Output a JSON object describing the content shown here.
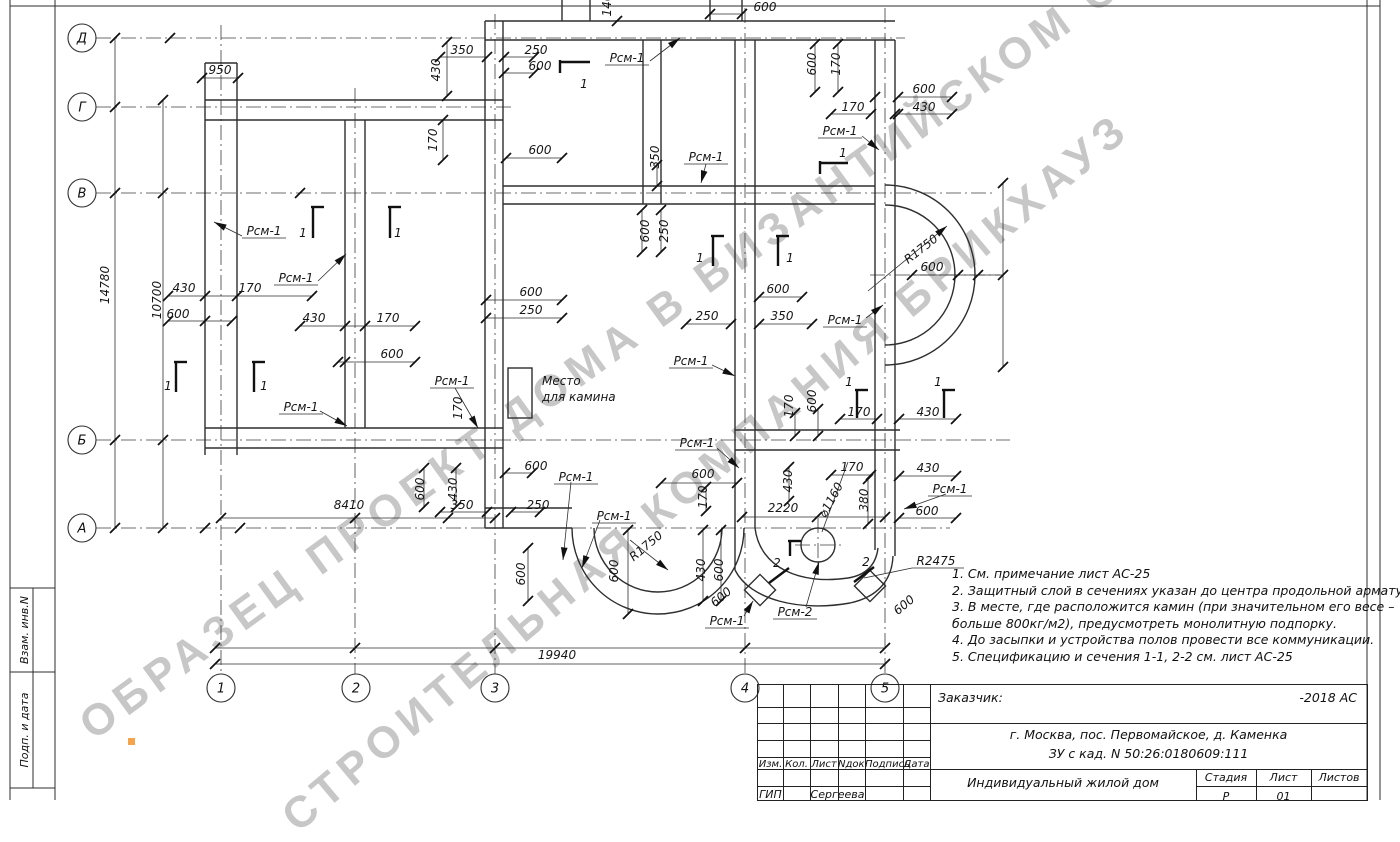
{
  "watermark": {
    "line1": "ОБРАЗЕЦ ПРОЕКТ ДОМА В ВИЗАНТИЙСКОМ СТИЛЕ",
    "line2": "СТРОИТЕЛЬНАЯ КОМПАНИЯ БРИКХАУЗ",
    "color": "#c7c7c7"
  },
  "sidebar": {
    "cells": [
      "Взам. инв.N",
      "Подп. и дата"
    ]
  },
  "axes": {
    "rows": [
      {
        "label": "Д",
        "y": 38
      },
      {
        "label": "Г",
        "y": 107
      },
      {
        "label": "В",
        "y": 193
      },
      {
        "label": "Б",
        "y": 440
      },
      {
        "label": "А",
        "y": 528
      }
    ],
    "cols": [
      {
        "label": "1",
        "x": 221
      },
      {
        "label": "2",
        "x": 356
      },
      {
        "label": "3",
        "x": 495
      },
      {
        "label": "4",
        "x": 745
      },
      {
        "label": "5",
        "x": 885
      }
    ]
  },
  "notes": {
    "lines": [
      "1. См. примечание лист АС-25",
      "2. Защитный слой в сечениях указан до центра продольной арматуры.",
      "3. В месте, где расположится камин (при значительном его весе –",
      "больше 800кг/м2), предусмотреть монолитную подпорку.",
      "4. До засыпки и устройства полов провести все коммуникации.",
      "5. Спецификацию и сечения 1-1, 2-2 см. лист АС-25"
    ]
  },
  "labels": [
    {
      "t": "950",
      "x": 220,
      "y": 70
    },
    {
      "t": "14780",
      "x": 105,
      "y": 285,
      "r": -90
    },
    {
      "t": "10700",
      "x": 157,
      "y": 300,
      "r": -90
    },
    {
      "t": "430",
      "x": 184,
      "y": 288
    },
    {
      "t": "170",
      "x": 250,
      "y": 288
    },
    {
      "t": "600",
      "x": 178,
      "y": 314
    },
    {
      "t": "Рсм-1",
      "x": 264,
      "y": 231,
      "u": 1
    },
    {
      "t": "Рсм-1",
      "x": 296,
      "y": 278,
      "u": 1
    },
    {
      "t": "Рсм-1",
      "x": 301,
      "y": 407,
      "u": 1
    },
    {
      "t": "430",
      "x": 314,
      "y": 318
    },
    {
      "t": "170",
      "x": 388,
      "y": 318
    },
    {
      "t": "600",
      "x": 392,
      "y": 354
    },
    {
      "t": "1",
      "x": 303,
      "y": 233
    },
    {
      "t": "1",
      "x": 398,
      "y": 233
    },
    {
      "t": "1",
      "x": 168,
      "y": 386
    },
    {
      "t": "1",
      "x": 264,
      "y": 386
    },
    {
      "t": "350",
      "x": 462,
      "y": 50
    },
    {
      "t": "250",
      "x": 536,
      "y": 50
    },
    {
      "t": "600",
      "x": 540,
      "y": 66
    },
    {
      "t": "430",
      "x": 436,
      "y": 70,
      "r": -90
    },
    {
      "t": "170",
      "x": 433,
      "y": 140,
      "r": -90
    },
    {
      "t": "600",
      "x": 540,
      "y": 150
    },
    {
      "t": "350",
      "x": 655,
      "y": 157,
      "r": -90
    },
    {
      "t": "Рсм-1",
      "x": 706,
      "y": 157,
      "u": 1
    },
    {
      "t": "Рсм-1",
      "x": 627,
      "y": 58,
      "u": 1
    },
    {
      "t": "1",
      "x": 584,
      "y": 84
    },
    {
      "t": "140",
      "x": 607,
      "y": 5,
      "r": -90
    },
    {
      "t": "600",
      "x": 765,
      "y": 7
    },
    {
      "t": "600",
      "x": 812,
      "y": 64,
      "r": -90
    },
    {
      "t": "170",
      "x": 836,
      "y": 64,
      "r": -90
    },
    {
      "t": "600",
      "x": 924,
      "y": 89
    },
    {
      "t": "430",
      "x": 924,
      "y": 107
    },
    {
      "t": "170",
      "x": 853,
      "y": 107
    },
    {
      "t": "Рсм-1",
      "x": 840,
      "y": 131,
      "u": 1
    },
    {
      "t": "1",
      "x": 843,
      "y": 153
    },
    {
      "t": "600",
      "x": 645,
      "y": 231,
      "r": -90
    },
    {
      "t": "250",
      "x": 664,
      "y": 231,
      "r": -90
    },
    {
      "t": "1",
      "x": 700,
      "y": 258
    },
    {
      "t": "1",
      "x": 790,
      "y": 258
    },
    {
      "t": "600",
      "x": 531,
      "y": 292
    },
    {
      "t": "250",
      "x": 531,
      "y": 310
    },
    {
      "t": "250",
      "x": 707,
      "y": 316
    },
    {
      "t": "350",
      "x": 782,
      "y": 316
    },
    {
      "t": "600",
      "x": 778,
      "y": 289
    },
    {
      "t": "Рсм-1",
      "x": 845,
      "y": 320,
      "u": 1
    },
    {
      "t": "R1750",
      "x": 921,
      "y": 249,
      "r": -38
    },
    {
      "t": "600",
      "x": 932,
      "y": 267
    },
    {
      "t": "Рсм-1",
      "x": 691,
      "y": 361,
      "u": 1
    },
    {
      "t": "Место",
      "x": 542,
      "y": 381,
      "s": 1
    },
    {
      "t": "для камина",
      "x": 542,
      "y": 397,
      "s": 1
    },
    {
      "t": "Рсм-1",
      "x": 452,
      "y": 381,
      "u": 1
    },
    {
      "t": "170",
      "x": 458,
      "y": 408,
      "r": -90
    },
    {
      "t": "170",
      "x": 789,
      "y": 406,
      "r": -90
    },
    {
      "t": "600",
      "x": 812,
      "y": 401,
      "r": -90
    },
    {
      "t": "1",
      "x": 849,
      "y": 382
    },
    {
      "t": "1",
      "x": 938,
      "y": 382
    },
    {
      "t": "170",
      "x": 859,
      "y": 412
    },
    {
      "t": "430",
      "x": 928,
      "y": 412
    },
    {
      "t": "Рсм-1",
      "x": 697,
      "y": 443,
      "u": 1
    },
    {
      "t": "600",
      "x": 703,
      "y": 474
    },
    {
      "t": "170",
      "x": 703,
      "y": 497,
      "r": -90
    },
    {
      "t": "430",
      "x": 788,
      "y": 481,
      "r": -90
    },
    {
      "t": "2220",
      "x": 783,
      "y": 508
    },
    {
      "t": "170",
      "x": 852,
      "y": 467
    },
    {
      "t": "430",
      "x": 928,
      "y": 468
    },
    {
      "t": "Рсм-1",
      "x": 950,
      "y": 489,
      "u": 1
    },
    {
      "t": "600",
      "x": 927,
      "y": 511
    },
    {
      "t": "380",
      "x": 864,
      "y": 500,
      "r": -90
    },
    {
      "t": "⌀1160",
      "x": 831,
      "y": 500,
      "r": -62
    },
    {
      "t": "R2475",
      "x": 936,
      "y": 561
    },
    {
      "t": "Рсм-2",
      "x": 795,
      "y": 612,
      "u": 1
    },
    {
      "t": "2",
      "x": 777,
      "y": 563
    },
    {
      "t": "2",
      "x": 866,
      "y": 562
    },
    {
      "t": "600",
      "x": 721,
      "y": 597,
      "r": -40
    },
    {
      "t": "600",
      "x": 904,
      "y": 605,
      "r": -40
    },
    {
      "t": "Рсм-1",
      "x": 727,
      "y": 621,
      "u": 1
    },
    {
      "t": "600",
      "x": 420,
      "y": 489,
      "r": -90
    },
    {
      "t": "430",
      "x": 453,
      "y": 489,
      "r": -90
    },
    {
      "t": "350",
      "x": 462,
      "y": 505
    },
    {
      "t": "250",
      "x": 538,
      "y": 505
    },
    {
      "t": "8410",
      "x": 349,
      "y": 505
    },
    {
      "t": "600",
      "x": 536,
      "y": 466
    },
    {
      "t": "Рсм-1",
      "x": 576,
      "y": 477,
      "u": 1
    },
    {
      "t": "Рсм-1",
      "x": 614,
      "y": 516,
      "u": 1
    },
    {
      "t": "R1750",
      "x": 646,
      "y": 546,
      "r": -40
    },
    {
      "t": "600",
      "x": 521,
      "y": 574,
      "r": -90
    },
    {
      "t": "600",
      "x": 614,
      "y": 571,
      "r": -90
    },
    {
      "t": "430",
      "x": 701,
      "y": 570,
      "r": -90
    },
    {
      "t": "600",
      "x": 719,
      "y": 570,
      "r": -90
    },
    {
      "t": "19940",
      "x": 557,
      "y": 655
    }
  ],
  "title_block": {
    "customer_label": "Заказчик:",
    "doc_code": "-2018 АС",
    "address_line1": "г. Москва, пос. Первомайское, д. Каменка",
    "address_line2": "ЗУ с кад. N 50:26:0180609:111",
    "columns": [
      "Изм.",
      "Кол.",
      "Лист",
      "Nдок.",
      "Подпись",
      "Дата"
    ],
    "role": "ГИП",
    "name": "Сергеева",
    "project": "Индивидуальный жилой дом",
    "stage_label": "Стадия",
    "sheet_label": "Лист",
    "sheets_label": "Листов",
    "stage": "Р",
    "sheet": "01"
  }
}
